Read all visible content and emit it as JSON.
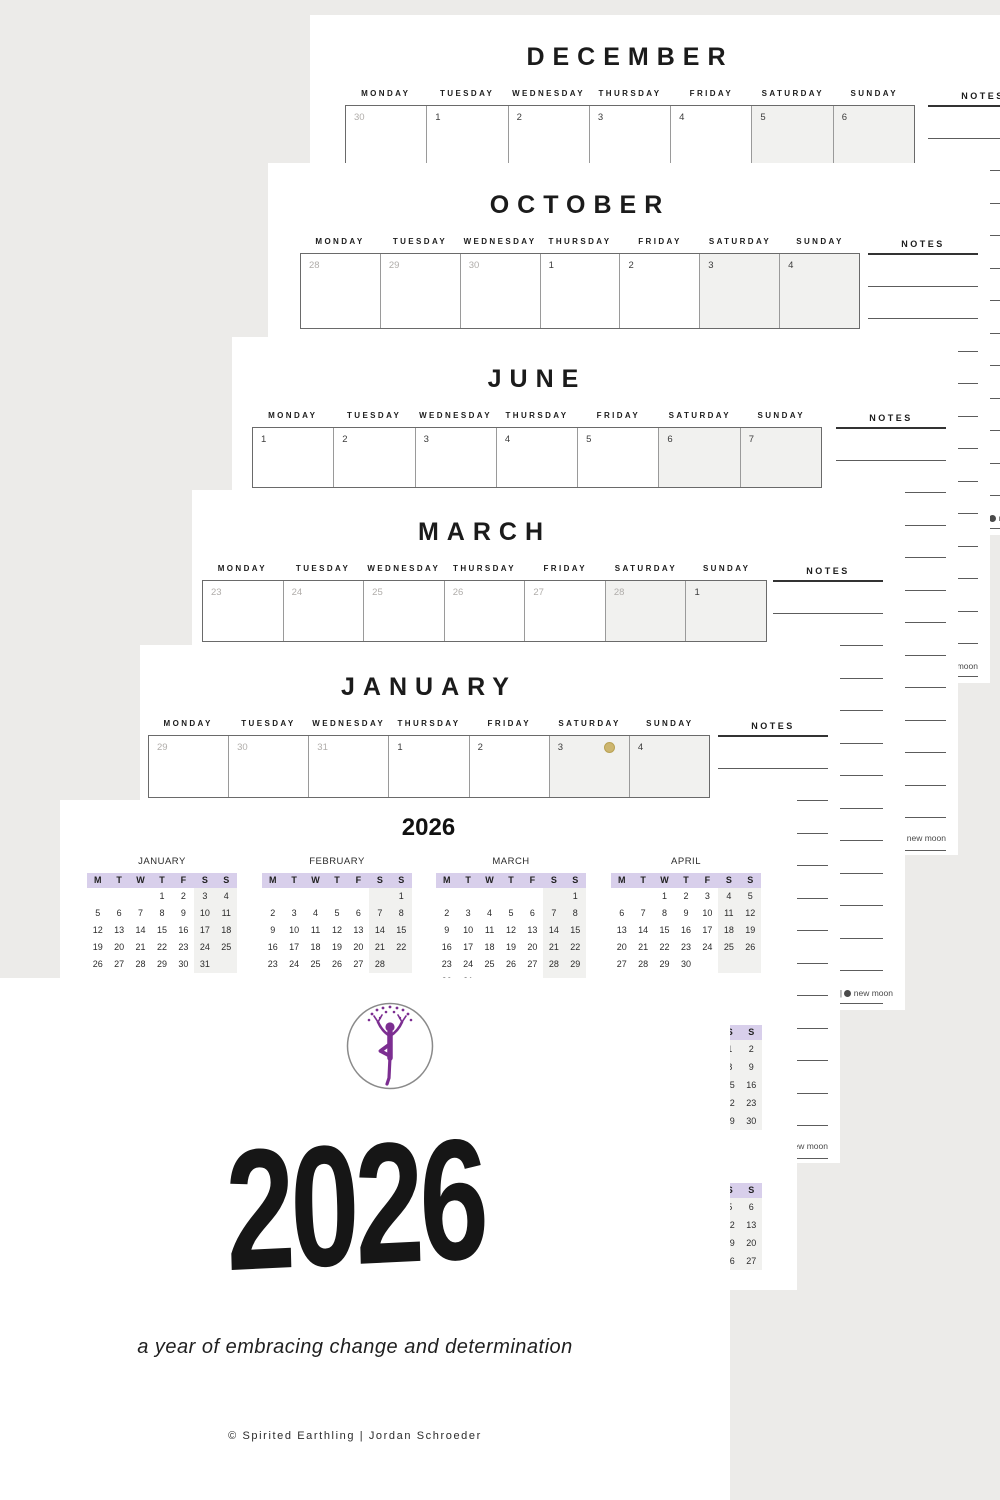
{
  "background": "#ecebe9",
  "colors": {
    "page_white": "#ffffff",
    "accent_lavender": "#d8cfeb",
    "weekend_fill": "#f1f1ef",
    "muted_date": "#b0adaa",
    "date_text": "#3c3c3c",
    "logo_purple": "#7c2e91",
    "moon_gold": "#cdb66f"
  },
  "weekday_labels": [
    "MONDAY",
    "TUESDAY",
    "WEDNESDAY",
    "THURSDAY",
    "FRIDAY",
    "SATURDAY",
    "SUNDAY"
  ],
  "notes_label": "NOTES",
  "legend": {
    "full_label": "full moon",
    "separator": "|",
    "new_label": "new moon"
  },
  "monthly_pages": [
    {
      "title": "DECEMBER",
      "dates": [
        {
          "n": "30",
          "muted": true
        },
        {
          "n": "1"
        },
        {
          "n": "2"
        },
        {
          "n": "3"
        },
        {
          "n": "4"
        },
        {
          "n": "5"
        },
        {
          "n": "6"
        }
      ]
    },
    {
      "title": "OCTOBER",
      "dates": [
        {
          "n": "28",
          "muted": true
        },
        {
          "n": "29",
          "muted": true
        },
        {
          "n": "30",
          "muted": true
        },
        {
          "n": "1"
        },
        {
          "n": "2"
        },
        {
          "n": "3"
        },
        {
          "n": "4"
        }
      ]
    },
    {
      "title": "JUNE",
      "dates": [
        {
          "n": "1"
        },
        {
          "n": "2"
        },
        {
          "n": "3"
        },
        {
          "n": "4"
        },
        {
          "n": "5"
        },
        {
          "n": "6"
        },
        {
          "n": "7"
        }
      ]
    },
    {
      "title": "MARCH",
      "dates": [
        {
          "n": "23",
          "muted": true
        },
        {
          "n": "24",
          "muted": true
        },
        {
          "n": "25",
          "muted": true
        },
        {
          "n": "26",
          "muted": true
        },
        {
          "n": "27",
          "muted": true
        },
        {
          "n": "28",
          "muted": true
        },
        {
          "n": "1"
        }
      ]
    },
    {
      "title": "JANUARY",
      "dates": [
        {
          "n": "29",
          "muted": true
        },
        {
          "n": "30",
          "muted": true
        },
        {
          "n": "31",
          "muted": true
        },
        {
          "n": "1"
        },
        {
          "n": "2"
        },
        {
          "n": "3",
          "moon": true
        },
        {
          "n": "4"
        }
      ]
    }
  ],
  "year_page": {
    "title": "2026",
    "day_headers": [
      "M",
      "T",
      "W",
      "T",
      "F",
      "S",
      "S"
    ],
    "months": [
      {
        "name": "JANUARY",
        "rows": [
          [
            "",
            "",
            "",
            "1",
            "2",
            "3",
            "4"
          ],
          [
            "5",
            "6",
            "7",
            "8",
            "9",
            "10",
            "11"
          ],
          [
            "12",
            "13",
            "14",
            "15",
            "16",
            "17",
            "18"
          ],
          [
            "19",
            "20",
            "21",
            "22",
            "23",
            "24",
            "25"
          ],
          [
            "26",
            "27",
            "28",
            "29",
            "30",
            "31",
            ""
          ]
        ]
      },
      {
        "name": "FEBRUARY",
        "rows": [
          [
            "",
            "",
            "",
            "",
            "",
            "",
            "1"
          ],
          [
            "2",
            "3",
            "4",
            "5",
            "6",
            "7",
            "8"
          ],
          [
            "9",
            "10",
            "11",
            "12",
            "13",
            "14",
            "15"
          ],
          [
            "16",
            "17",
            "18",
            "19",
            "20",
            "21",
            "22"
          ],
          [
            "23",
            "24",
            "25",
            "26",
            "27",
            "28",
            ""
          ]
        ]
      },
      {
        "name": "MARCH",
        "rows": [
          [
            "",
            "",
            "",
            "",
            "",
            "",
            "1"
          ],
          [
            "2",
            "3",
            "4",
            "5",
            "6",
            "7",
            "8"
          ],
          [
            "9",
            "10",
            "11",
            "12",
            "13",
            "14",
            "15"
          ],
          [
            "16",
            "17",
            "18",
            "19",
            "20",
            "21",
            "22"
          ],
          [
            "23",
            "24",
            "25",
            "26",
            "27",
            "28",
            "29"
          ],
          [
            "30",
            "31",
            "",
            "",
            "",
            "",
            ""
          ]
        ]
      },
      {
        "name": "APRIL",
        "rows": [
          [
            "",
            "",
            "1",
            "2",
            "3",
            "4",
            "5"
          ],
          [
            "6",
            "7",
            "8",
            "9",
            "10",
            "11",
            "12"
          ],
          [
            "13",
            "14",
            "15",
            "16",
            "17",
            "18",
            "19"
          ],
          [
            "20",
            "21",
            "22",
            "23",
            "24",
            "25",
            "26"
          ],
          [
            "27",
            "28",
            "29",
            "30",
            "",
            "",
            ""
          ]
        ]
      }
    ],
    "weekend_fragments": [
      {
        "headers": [
          "S",
          "S"
        ],
        "rows": [
          [
            "1",
            "2"
          ],
          [
            "8",
            "9"
          ],
          [
            "15",
            "16"
          ],
          [
            "22",
            "23"
          ],
          [
            "29",
            "30"
          ]
        ]
      },
      {
        "headers": [
          "S",
          "S"
        ],
        "rows": [
          [
            "5",
            "6"
          ],
          [
            "12",
            "13"
          ],
          [
            "19",
            "20"
          ],
          [
            "26",
            "27"
          ]
        ]
      }
    ]
  },
  "cover": {
    "year": "2026",
    "subtitle": "a year of embracing change and determination",
    "credit": "© Spirited Earthling | Jordan Schroeder"
  }
}
